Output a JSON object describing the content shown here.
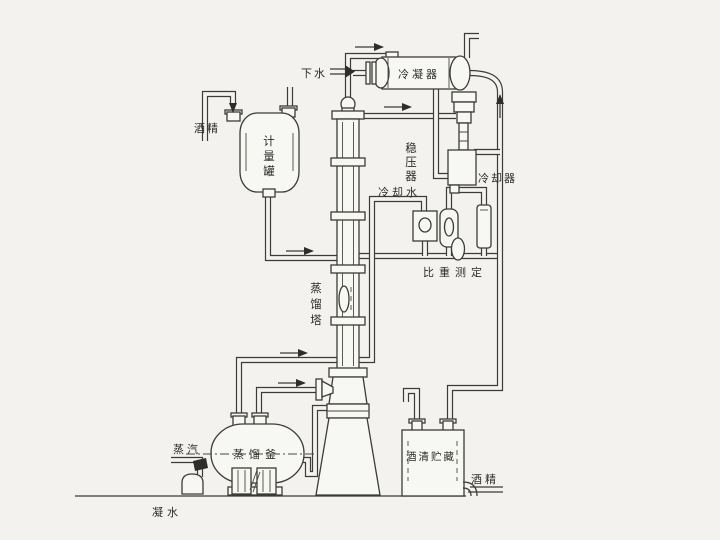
{
  "diagram": {
    "title_hint": "alcohol distillation process diagram",
    "colors": {
      "paper": "#f3f2ee",
      "line": "#3c3b37",
      "vessel_fill": "#f7f8f3"
    },
    "labels": {
      "drain_water": "下水",
      "condenser": "冷凝器",
      "pressure_stabilizer": "稳压器",
      "cooler": "冷却器",
      "cooling_water": "冷却水",
      "gravity_measurement": "比重测定",
      "alcohol_feed": "酒精",
      "measuring_tank": "计量罐",
      "distillation_column": "蒸馏塔",
      "distillation_still": "蒸馏釜",
      "steam": "蒸汽",
      "condensate": "凝水",
      "alcohol_storage": "酒清贮藏",
      "alcohol_out": "酒精"
    }
  }
}
